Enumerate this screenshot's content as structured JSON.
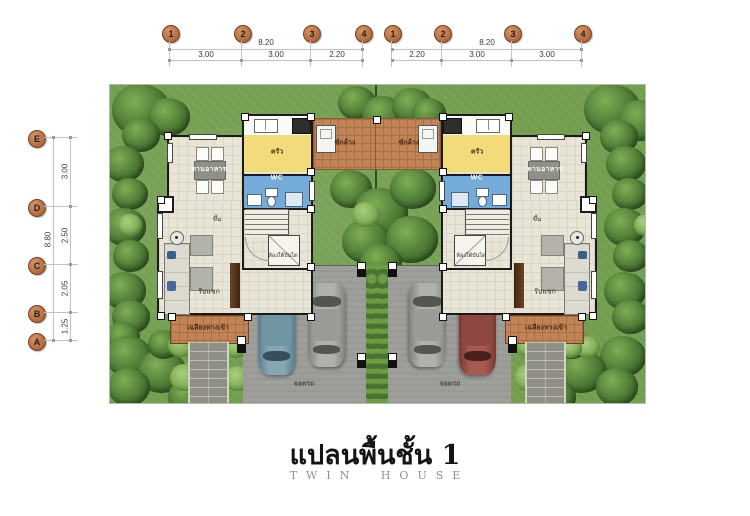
{
  "title": {
    "thai": "แปลนพื้นชั้น 1",
    "en": "TWIN HOUSE"
  },
  "axes": {
    "top_left": {
      "circles": [
        "1",
        "2",
        "3",
        "4"
      ],
      "total": "8.20",
      "segments": [
        "3.00",
        "3.00",
        "2.20"
      ]
    },
    "top_right": {
      "circles": [
        "1",
        "2",
        "3",
        "4"
      ],
      "total": "8.20",
      "segments": [
        "2.20",
        "3.00",
        "3.00"
      ]
    },
    "left": {
      "circles": [
        "E",
        "D",
        "C",
        "B",
        "A"
      ],
      "total": "8.80",
      "segments": [
        "3.00",
        "2.50",
        "2.05",
        "1.25"
      ]
    }
  },
  "rooms": {
    "dining": "ทานอาหาร",
    "kitchen": "ครัว",
    "wc": "WC",
    "living": "รับแขก",
    "porch": "เฉลียงทางเข้า",
    "washing": "ซักล้าง",
    "parking": "จอดรถ",
    "under_stairs": "ห้องใต้บันได",
    "stairs_up": "ขึ้น"
  },
  "colors": {
    "lawn": "#76a153",
    "floor": "#e9e5d6",
    "kitchen": "#f1db7b",
    "wc": "#74abd9",
    "terracotta": "#c08457",
    "driveway": "#9e9e9a",
    "grid_circle": "#b06a3f"
  }
}
